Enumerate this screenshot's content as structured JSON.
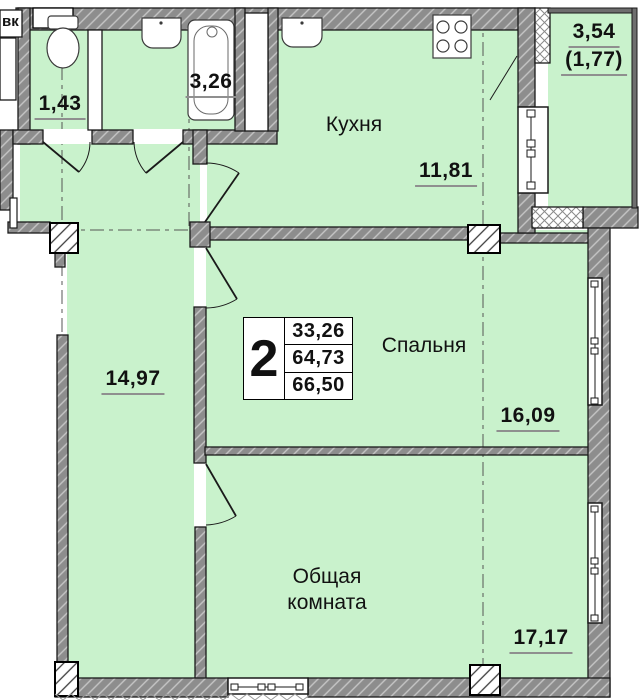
{
  "rooms": {
    "corner_label": "вк",
    "wc": {
      "area": "1,43"
    },
    "bathroom": {
      "area": "3,26"
    },
    "kitchen": {
      "name": "Кухня",
      "area": "11,81"
    },
    "balcony": {
      "area_total": "3,54",
      "area_reduced": "(1,77)"
    },
    "hall": {
      "area": "14,97"
    },
    "bedroom": {
      "name": "Спальня",
      "area": "16,09"
    },
    "living_room": {
      "name_line1": "Общая",
      "name_line2": "комната",
      "area": "17,17"
    }
  },
  "info_table": {
    "rooms_count": "2",
    "living_area": "33,26",
    "area_row2": "64,73",
    "total_area": "66,50"
  },
  "colors": {
    "floor_green": "#c9f2cc",
    "wall_gray": "#8d8d8d",
    "outline_black": "#1a1a1a"
  },
  "icons": [
    "toilet-icon",
    "bathtub-icon",
    "sink-icon",
    "stove-icon",
    "window-icon",
    "door-swing-icon",
    "pillar-icon",
    "axis-line"
  ]
}
